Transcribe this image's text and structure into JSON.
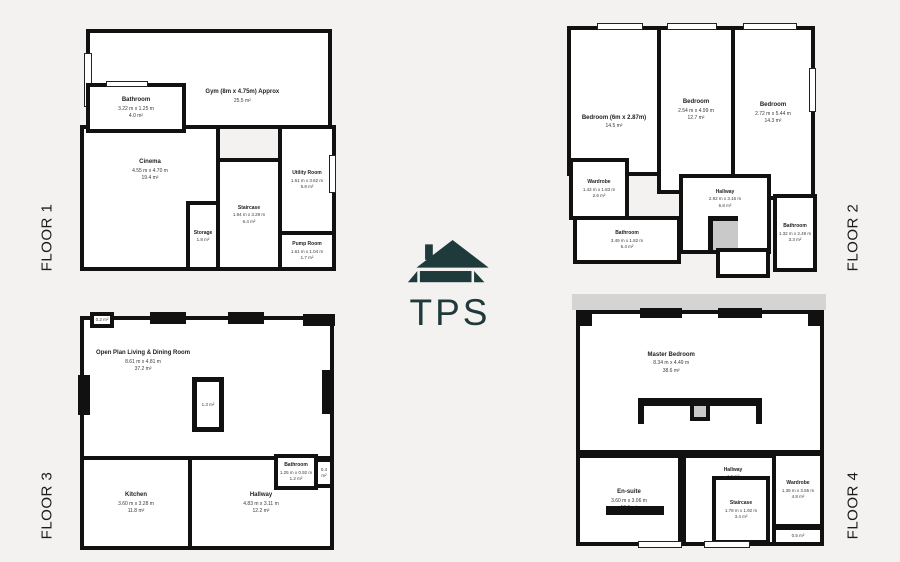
{
  "logo": {
    "text": "TPS",
    "color": "#1f3a3a",
    "icon": "house-icon"
  },
  "colors": {
    "background": "#f4f2f0",
    "wall": "#111111",
    "room": "#ffffff",
    "gray_accent": "#c9c9c9"
  },
  "floors": {
    "f1": {
      "label": "FLOOR 1",
      "rooms": {
        "gym": {
          "name": "Gym (8m x 4.75m) Approx",
          "area": "25.5 m²"
        },
        "bathroom": {
          "name": "Bathroom",
          "dims": "3.22 m x 1.25 m",
          "area": "4.0 m²"
        },
        "cinema": {
          "name": "Cinema",
          "dims": "4.55 m x 4.70 m",
          "area": "19.4 m²"
        },
        "storage": {
          "name": "Storage",
          "area": "1.8 m²"
        },
        "staircase": {
          "name": "Staircase",
          "dims": "1.94 m x 3.29 m",
          "area": "6.4 m²"
        },
        "utility": {
          "name": "Utility Room",
          "dims": "1.61 m x 3.62 m",
          "area": "5.8 m²"
        },
        "pump": {
          "name": "Pump Room",
          "dims": "1.61 m x 1.04 m",
          "area": "1.7 m²"
        }
      }
    },
    "f2": {
      "label": "FLOOR 2",
      "rooms": {
        "bedroom_left": {
          "name": "Bedroom (6m x 2.87m)",
          "area": "14.5 m²"
        },
        "bedroom_middle": {
          "name": "Bedroom",
          "dims": "2.54 m x 4.99 m",
          "area": "12.7 m²"
        },
        "bedroom_right": {
          "name": "Bedroom",
          "dims": "2.72 m x 5.44 m",
          "area": "14.3 m²"
        },
        "wardrobe": {
          "name": "Wardrobe",
          "dims": "1.42 m x 1.83 m",
          "area": "2.6 m²"
        },
        "bathroom_left": {
          "name": "Bathroom",
          "dims": "3.49 m x 1.82 m",
          "area": "6.4 m²"
        },
        "hallway": {
          "name": "Hallway",
          "dims": "2.92 m x 3.16 m",
          "area": "6.8 m²"
        },
        "bathroom_right": {
          "name": "Bathroom",
          "dims": "1.32 m x 2.49 m",
          "area": "3.3 m²"
        }
      }
    },
    "f3": {
      "label": "FLOOR 3",
      "rooms": {
        "openplan": {
          "name": "Open Plan Living & Dining Room",
          "dims": "8.61 m x 4.81 m",
          "area": "37.2 m²"
        },
        "corner": {
          "area": "0.2 m²"
        },
        "column": {
          "area": "1.3 m²"
        },
        "kitchen": {
          "name": "Kitchen",
          "dims": "3.60 m x 3.28 m",
          "area": "11.8 m²"
        },
        "hallway": {
          "name": "Hallway",
          "dims": "4.83 m x 3.11 m",
          "area": "12.2 m²"
        },
        "bathroom": {
          "name": "Bathroom",
          "dims": "1.25 m x 0.92 m",
          "area": "1.2 m²"
        },
        "cupboard": {
          "area": "0.4 m²"
        }
      }
    },
    "f4": {
      "label": "FLOOR 4",
      "rooms": {
        "master": {
          "name": "Master Bedroom",
          "dims": "8.34 m x 4.49 m",
          "area": "38.6 m²"
        },
        "ensuite": {
          "name": "En-suite",
          "dims": "3.60 m x 3.06 m",
          "area": "10.5 m²"
        },
        "hallway": {
          "name": "Hallway",
          "area": "4.2 m²"
        },
        "staircase": {
          "name": "Staircase",
          "dims": "1.78 m x 1.92 m",
          "area": "3.4 m²"
        },
        "wardrobe": {
          "name": "Wardrobe",
          "dims": "1.36 m x 3.55 m",
          "area": "4.8 m²"
        },
        "cupboard": {
          "area": "0.5 m²"
        }
      }
    }
  }
}
